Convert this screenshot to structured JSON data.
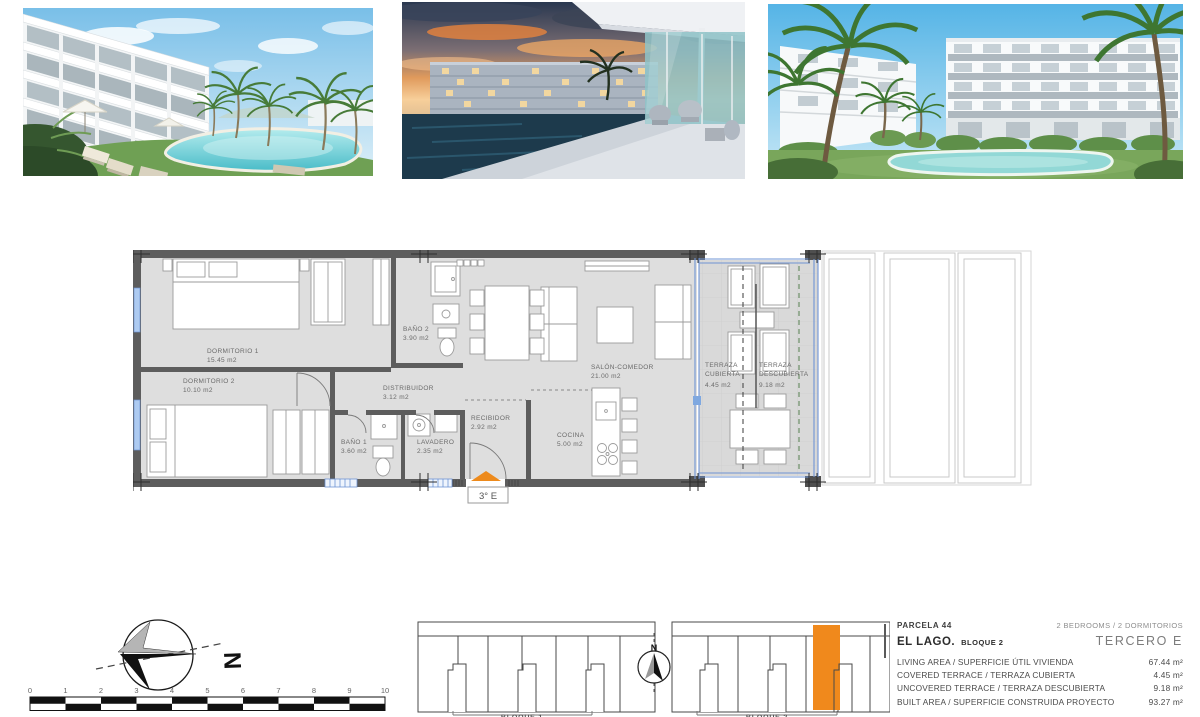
{
  "page": {
    "title": "El Lago floor plan sheet"
  },
  "floorplan": {
    "rooms": [
      {
        "name": "DORMITORIO 1",
        "area": "15.45 m2"
      },
      {
        "name": "DORMITORIO 2",
        "area": "10.10 m2"
      },
      {
        "name": "BAÑO 2",
        "area": "3.90 m2"
      },
      {
        "name": "DISTRIBUIDOR",
        "area": "3.12 m2"
      },
      {
        "name": "BAÑO 1",
        "area": "3.60 m2"
      },
      {
        "name": "LAVADERO",
        "area": "2.35 m2"
      },
      {
        "name": "RECIBIDOR",
        "area": "2.92 m2"
      },
      {
        "name": "COCINA",
        "area": "5.00 m2"
      },
      {
        "name": "SALÓN-COMEDOR",
        "area": "21.00 m2"
      }
    ],
    "terrace_covered": {
      "line1": "TERRAZA",
      "line2": "CUBIERTA",
      "area": "4.45 m2"
    },
    "terrace_uncovered": {
      "line1": "TERRAZA",
      "line2": "DESCUBIERTA",
      "area": "9.18 m2"
    },
    "unit_label": "3° E"
  },
  "compass": {
    "north": "N"
  },
  "site_compass": {
    "north": "N"
  },
  "scalebar": {
    "ticks": [
      "0",
      "1",
      "2",
      "3",
      "4",
      "5",
      "6",
      "7",
      "8",
      "9",
      "10"
    ]
  },
  "site": {
    "block1": "BLOQUE 1",
    "block2": "BLOQUE 2"
  },
  "details": {
    "parcela": "PARCELA 44",
    "bedrooms": "2 BEDROOMS / 2 DORMITORIOS",
    "name": "EL LAGO.",
    "block": "BLOQUE 2",
    "floor": "TERCERO E",
    "rows": [
      {
        "label": "LIVING AREA / SUPERFICIE ÚTIL VIVIENDA",
        "value": "67.44 m²"
      },
      {
        "label": "COVERED TERRACE / TERRAZA CUBIERTA",
        "value": "4.45 m²"
      },
      {
        "label": "UNCOVERED TERRACE / TERRAZA DESCUBIERTA",
        "value": "9.18 m²"
      },
      {
        "label": "BUILT AREA / SUPERFICIE CONSTRUIDA PROYECTO",
        "value": "93.27 m²"
      }
    ]
  },
  "colors": {
    "accent_orange": "#ED8A1C",
    "window_blue": "#6F94D4",
    "wall_gray": "#5D5D5D",
    "floor_gray": "#DEDEDE"
  }
}
